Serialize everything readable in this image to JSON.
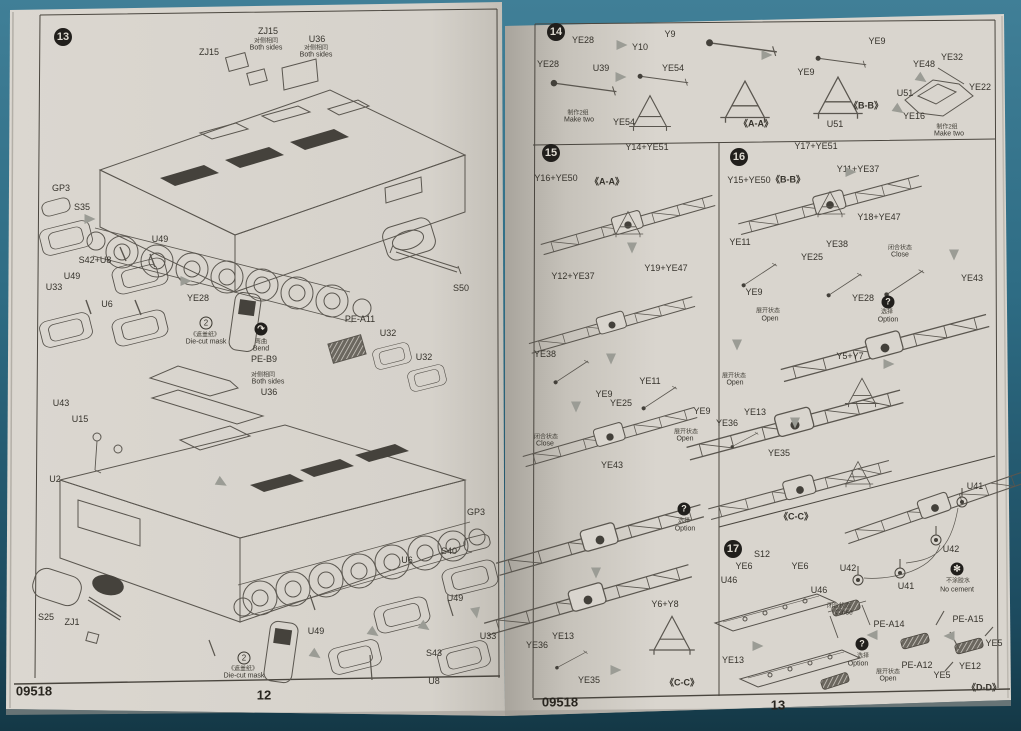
{
  "document": {
    "type": "model-kit-assembly-instructions",
    "product_code": "09518",
    "left_page_number": "12",
    "right_page_number": "13",
    "steps_shown": [
      "13",
      "14",
      "15",
      "16",
      "17"
    ]
  },
  "colors": {
    "background_teal": "#2e6c84",
    "paper": "#d9d5ce",
    "ink": "#36332c",
    "badge_black": "#211f1c",
    "arrow_gray": "#9b9c95"
  },
  "left_page": {
    "step_badges": [
      {
        "n": "13",
        "x": 63,
        "y": 37
      }
    ],
    "labels": [
      {
        "t": "ZJ15",
        "x": 209,
        "y": 52
      },
      {
        "t": "ZJ15",
        "x": 268,
        "y": 31
      },
      {
        "t": "对侧相同",
        "x": 266,
        "y": 40,
        "k": "cn"
      },
      {
        "t": "Both sides",
        "x": 266,
        "y": 48,
        "k": "en"
      },
      {
        "t": "U36",
        "x": 317,
        "y": 39
      },
      {
        "t": "对侧相同",
        "x": 316,
        "y": 47,
        "k": "cn"
      },
      {
        "t": "Both sides",
        "x": 316,
        "y": 55,
        "k": "en"
      },
      {
        "t": "GP3",
        "x": 61,
        "y": 188
      },
      {
        "t": "S35",
        "x": 82,
        "y": 207
      },
      {
        "t": "U49",
        "x": 160,
        "y": 239
      },
      {
        "t": "S42+U8",
        "x": 95,
        "y": 260
      },
      {
        "t": "U49",
        "x": 72,
        "y": 276
      },
      {
        "t": "U33",
        "x": 54,
        "y": 287
      },
      {
        "t": "U6",
        "x": 107,
        "y": 304
      },
      {
        "t": "YE28",
        "x": 198,
        "y": 298
      },
      {
        "t": "《遮盖纸》",
        "x": 205,
        "y": 334,
        "k": "cn"
      },
      {
        "t": "Die-cut mask",
        "x": 206,
        "y": 342,
        "k": "en"
      },
      {
        "t": "弯曲",
        "x": 261,
        "y": 341,
        "k": "cn"
      },
      {
        "t": "Bend",
        "x": 261,
        "y": 349,
        "k": "en"
      },
      {
        "t": "PE-B9",
        "x": 264,
        "y": 359
      },
      {
        "t": "对侧相同",
        "x": 263,
        "y": 374,
        "k": "cn"
      },
      {
        "t": "Both sides",
        "x": 268,
        "y": 382,
        "k": "en"
      },
      {
        "t": "U36",
        "x": 269,
        "y": 392
      },
      {
        "t": "PE-A11",
        "x": 360,
        "y": 319
      },
      {
        "t": "U32",
        "x": 388,
        "y": 333
      },
      {
        "t": "U32",
        "x": 424,
        "y": 357
      },
      {
        "t": "S50",
        "x": 461,
        "y": 288
      },
      {
        "t": "U43",
        "x": 61,
        "y": 403
      },
      {
        "t": "U15",
        "x": 80,
        "y": 419
      },
      {
        "t": "U2",
        "x": 55,
        "y": 479
      },
      {
        "t": "S25",
        "x": 46,
        "y": 617
      },
      {
        "t": "ZJ1",
        "x": 72,
        "y": 622
      },
      {
        "t": "《遮盖纸》",
        "x": 243,
        "y": 668,
        "k": "cn"
      },
      {
        "t": "Die-cut mask",
        "x": 244,
        "y": 676,
        "k": "en"
      },
      {
        "t": "U49",
        "x": 316,
        "y": 631
      },
      {
        "t": "U49",
        "x": 455,
        "y": 598
      },
      {
        "t": "U33",
        "x": 488,
        "y": 636
      },
      {
        "t": "S43",
        "x": 434,
        "y": 653
      },
      {
        "t": "U8",
        "x": 434,
        "y": 681
      },
      {
        "t": "U6",
        "x": 407,
        "y": 560
      },
      {
        "t": "S40",
        "x": 449,
        "y": 551
      },
      {
        "t": "GP3",
        "x": 476,
        "y": 512
      },
      {
        "t": "09518",
        "x": 34,
        "y": 691,
        "k": "footer",
        "n": "footer-product-code"
      },
      {
        "t": "12",
        "x": 264,
        "y": 695,
        "k": "footer",
        "n": "footer-page-number"
      }
    ],
    "icons": [
      {
        "type": "circle2",
        "glyph": "2",
        "x": 206,
        "y": 323,
        "name": "die-cut-mask-2-icon"
      },
      {
        "type": "circle2",
        "glyph": "2",
        "x": 244,
        "y": 658,
        "name": "die-cut-mask-2-icon"
      },
      {
        "type": "solid",
        "glyph": "↷",
        "x": 261,
        "y": 329,
        "name": "bend-icon"
      }
    ],
    "arrows": [
      {
        "x": 90,
        "y": 219,
        "r": 0
      },
      {
        "x": 186,
        "y": 281,
        "r": 0
      },
      {
        "x": 374,
        "y": 633,
        "r": 35
      },
      {
        "x": 425,
        "y": 627,
        "r": 35
      },
      {
        "x": 476,
        "y": 613,
        "r": 80
      },
      {
        "x": 316,
        "y": 655,
        "r": 35
      },
      {
        "x": 222,
        "y": 483,
        "r": 30
      }
    ]
  },
  "right_page": {
    "step_badges": [
      {
        "n": "14",
        "x": 556,
        "y": 32
      },
      {
        "n": "15",
        "x": 551,
        "y": 153
      },
      {
        "n": "16",
        "x": 739,
        "y": 157
      },
      {
        "n": "17",
        "x": 733,
        "y": 549
      }
    ],
    "labels": [
      {
        "t": "YE28",
        "x": 583,
        "y": 40
      },
      {
        "t": "YE28",
        "x": 548,
        "y": 64
      },
      {
        "t": "U39",
        "x": 601,
        "y": 68
      },
      {
        "t": "Y10",
        "x": 640,
        "y": 47
      },
      {
        "t": "Y9",
        "x": 670,
        "y": 34
      },
      {
        "t": "YE54",
        "x": 673,
        "y": 68
      },
      {
        "t": "YE54",
        "x": 624,
        "y": 122
      },
      {
        "t": "制作2组",
        "x": 578,
        "y": 112,
        "k": "cn"
      },
      {
        "t": "Make two",
        "x": 579,
        "y": 120,
        "k": "en"
      },
      {
        "t": "《A-A》",
        "x": 756,
        "y": 123,
        "k": "ref"
      },
      {
        "t": "YE9",
        "x": 806,
        "y": 72
      },
      {
        "t": "U51",
        "x": 835,
        "y": 124
      },
      {
        "t": "《B-B》",
        "x": 866,
        "y": 105,
        "k": "ref"
      },
      {
        "t": "YE9",
        "x": 877,
        "y": 41
      },
      {
        "t": "U51",
        "x": 905,
        "y": 93
      },
      {
        "t": "YE48",
        "x": 924,
        "y": 64
      },
      {
        "t": "YE32",
        "x": 952,
        "y": 57
      },
      {
        "t": "YE22",
        "x": 980,
        "y": 87
      },
      {
        "t": "YE16",
        "x": 914,
        "y": 116
      },
      {
        "t": "制作2组",
        "x": 947,
        "y": 126,
        "k": "cn"
      },
      {
        "t": "Make two",
        "x": 949,
        "y": 134,
        "k": "en"
      },
      {
        "t": "Y14+YE51",
        "x": 647,
        "y": 147
      },
      {
        "t": "Y16+YE50",
        "x": 556,
        "y": 178
      },
      {
        "t": "《A-A》",
        "x": 607,
        "y": 181,
        "k": "ref"
      },
      {
        "t": "Y12+YE37",
        "x": 573,
        "y": 276
      },
      {
        "t": "Y19+YE47",
        "x": 666,
        "y": 268
      },
      {
        "t": "YE38",
        "x": 545,
        "y": 354
      },
      {
        "t": "YE9",
        "x": 604,
        "y": 394
      },
      {
        "t": "YE25",
        "x": 621,
        "y": 403
      },
      {
        "t": "YE11",
        "x": 650,
        "y": 381
      },
      {
        "t": "YE9",
        "x": 702,
        "y": 411
      },
      {
        "t": "闭合状态",
        "x": 546,
        "y": 436,
        "k": "cn"
      },
      {
        "t": "Close",
        "x": 545,
        "y": 444,
        "k": "en"
      },
      {
        "t": "展开状态",
        "x": 686,
        "y": 431,
        "k": "cn"
      },
      {
        "t": "Open",
        "x": 685,
        "y": 439,
        "k": "en"
      },
      {
        "t": "YE43",
        "x": 612,
        "y": 465
      },
      {
        "t": "选择",
        "x": 684,
        "y": 520,
        "k": "cn"
      },
      {
        "t": "Option",
        "x": 685,
        "y": 529,
        "k": "en"
      },
      {
        "t": "Y6+Y8",
        "x": 665,
        "y": 604
      },
      {
        "t": "YE13",
        "x": 563,
        "y": 636
      },
      {
        "t": "YE36",
        "x": 537,
        "y": 645
      },
      {
        "t": "YE35",
        "x": 589,
        "y": 680
      },
      {
        "t": "《C-C》",
        "x": 682,
        "y": 682,
        "k": "ref"
      },
      {
        "t": "Y17+YE51",
        "x": 816,
        "y": 146
      },
      {
        "t": "Y11+YE37",
        "x": 858,
        "y": 169
      },
      {
        "t": "Y15+YE50",
        "x": 749,
        "y": 180
      },
      {
        "t": "《B-B》",
        "x": 788,
        "y": 179,
        "k": "ref"
      },
      {
        "t": "Y18+YE47",
        "x": 879,
        "y": 217
      },
      {
        "t": "YE11",
        "x": 740,
        "y": 242
      },
      {
        "t": "YE38",
        "x": 837,
        "y": 244
      },
      {
        "t": "YE25",
        "x": 812,
        "y": 257
      },
      {
        "t": "闭合状态",
        "x": 900,
        "y": 247,
        "k": "cn"
      },
      {
        "t": "Close",
        "x": 900,
        "y": 255,
        "k": "en"
      },
      {
        "t": "YE9",
        "x": 754,
        "y": 292
      },
      {
        "t": "展开状态",
        "x": 768,
        "y": 310,
        "k": "cn"
      },
      {
        "t": "Open",
        "x": 770,
        "y": 319,
        "k": "en"
      },
      {
        "t": "YE28",
        "x": 863,
        "y": 298
      },
      {
        "t": "选择",
        "x": 887,
        "y": 311,
        "k": "cn"
      },
      {
        "t": "Option",
        "x": 888,
        "y": 320,
        "k": "en"
      },
      {
        "t": "YE43",
        "x": 972,
        "y": 278
      },
      {
        "t": "展开状态",
        "x": 734,
        "y": 375,
        "k": "cn"
      },
      {
        "t": "Open",
        "x": 735,
        "y": 383,
        "k": "en"
      },
      {
        "t": "Y5+Y7",
        "x": 850,
        "y": 356
      },
      {
        "t": "YE13",
        "x": 755,
        "y": 412
      },
      {
        "t": "YE36",
        "x": 727,
        "y": 423
      },
      {
        "t": "YE35",
        "x": 779,
        "y": 453
      },
      {
        "t": "《C-C》",
        "x": 796,
        "y": 516,
        "k": "ref"
      },
      {
        "t": "U41",
        "x": 975,
        "y": 486
      },
      {
        "t": "U42",
        "x": 951,
        "y": 549
      },
      {
        "t": "U42",
        "x": 848,
        "y": 568
      },
      {
        "t": "U41",
        "x": 906,
        "y": 586
      },
      {
        "t": "不涂胶水",
        "x": 958,
        "y": 580,
        "k": "cn"
      },
      {
        "t": "No cement",
        "x": 957,
        "y": 590,
        "k": "en"
      },
      {
        "t": "S12",
        "x": 762,
        "y": 554
      },
      {
        "t": "YE6",
        "x": 744,
        "y": 566
      },
      {
        "t": "YE6",
        "x": 800,
        "y": 566
      },
      {
        "t": "U46",
        "x": 729,
        "y": 580
      },
      {
        "t": "U46",
        "x": 819,
        "y": 590
      },
      {
        "t": "YE13",
        "x": 733,
        "y": 660
      },
      {
        "t": "闭合状态",
        "x": 839,
        "y": 605,
        "k": "cn"
      },
      {
        "t": "Close",
        "x": 844,
        "y": 613,
        "k": "en"
      },
      {
        "t": "PE-A14",
        "x": 889,
        "y": 624
      },
      {
        "t": "PE-A15",
        "x": 968,
        "y": 619
      },
      {
        "t": "选择",
        "x": 863,
        "y": 655,
        "k": "cn"
      },
      {
        "t": "Option",
        "x": 858,
        "y": 664,
        "k": "en"
      },
      {
        "t": "PE-A12",
        "x": 917,
        "y": 665
      },
      {
        "t": "展开状态",
        "x": 888,
        "y": 671,
        "k": "cn"
      },
      {
        "t": "Open",
        "x": 888,
        "y": 679,
        "k": "en"
      },
      {
        "t": "YE5",
        "x": 942,
        "y": 675
      },
      {
        "t": "YE12",
        "x": 970,
        "y": 666
      },
      {
        "t": "YE5",
        "x": 994,
        "y": 643
      },
      {
        "t": "《D-D》",
        "x": 984,
        "y": 687,
        "k": "ref"
      },
      {
        "t": "09518",
        "x": 560,
        "y": 702,
        "k": "footer",
        "n": "footer-product-code"
      },
      {
        "t": "13",
        "x": 778,
        "y": 705,
        "k": "footer",
        "n": "footer-page-number"
      }
    ],
    "icons": [
      {
        "type": "solid",
        "glyph": "?",
        "x": 684,
        "y": 509,
        "name": "option-icon"
      },
      {
        "type": "solid",
        "glyph": "?",
        "x": 888,
        "y": 302,
        "name": "option-icon"
      },
      {
        "type": "solid",
        "glyph": "?",
        "x": 862,
        "y": 644,
        "name": "option-icon"
      },
      {
        "type": "solid",
        "glyph": "✻",
        "x": 957,
        "y": 569,
        "name": "no-cement-icon"
      }
    ],
    "arrows": [
      {
        "x": 622,
        "y": 45,
        "r": 0
      },
      {
        "x": 621,
        "y": 77,
        "r": 0
      },
      {
        "x": 767,
        "y": 55,
        "r": 0
      },
      {
        "x": 899,
        "y": 110,
        "r": 35
      },
      {
        "x": 922,
        "y": 79,
        "r": 35
      },
      {
        "x": 632,
        "y": 248,
        "r": 90
      },
      {
        "x": 611,
        "y": 359,
        "r": 90
      },
      {
        "x": 576,
        "y": 407,
        "r": 90
      },
      {
        "x": 596,
        "y": 573,
        "r": 90
      },
      {
        "x": 616,
        "y": 670,
        "r": 0
      },
      {
        "x": 851,
        "y": 172,
        "r": 0
      },
      {
        "x": 954,
        "y": 255,
        "r": 90
      },
      {
        "x": 889,
        "y": 364,
        "r": 0
      },
      {
        "x": 795,
        "y": 423,
        "r": 90
      },
      {
        "x": 758,
        "y": 646,
        "r": 0
      },
      {
        "x": 872,
        "y": 635,
        "r": 180
      },
      {
        "x": 949,
        "y": 636,
        "r": 180
      },
      {
        "x": 737,
        "y": 345,
        "r": 90
      }
    ]
  }
}
